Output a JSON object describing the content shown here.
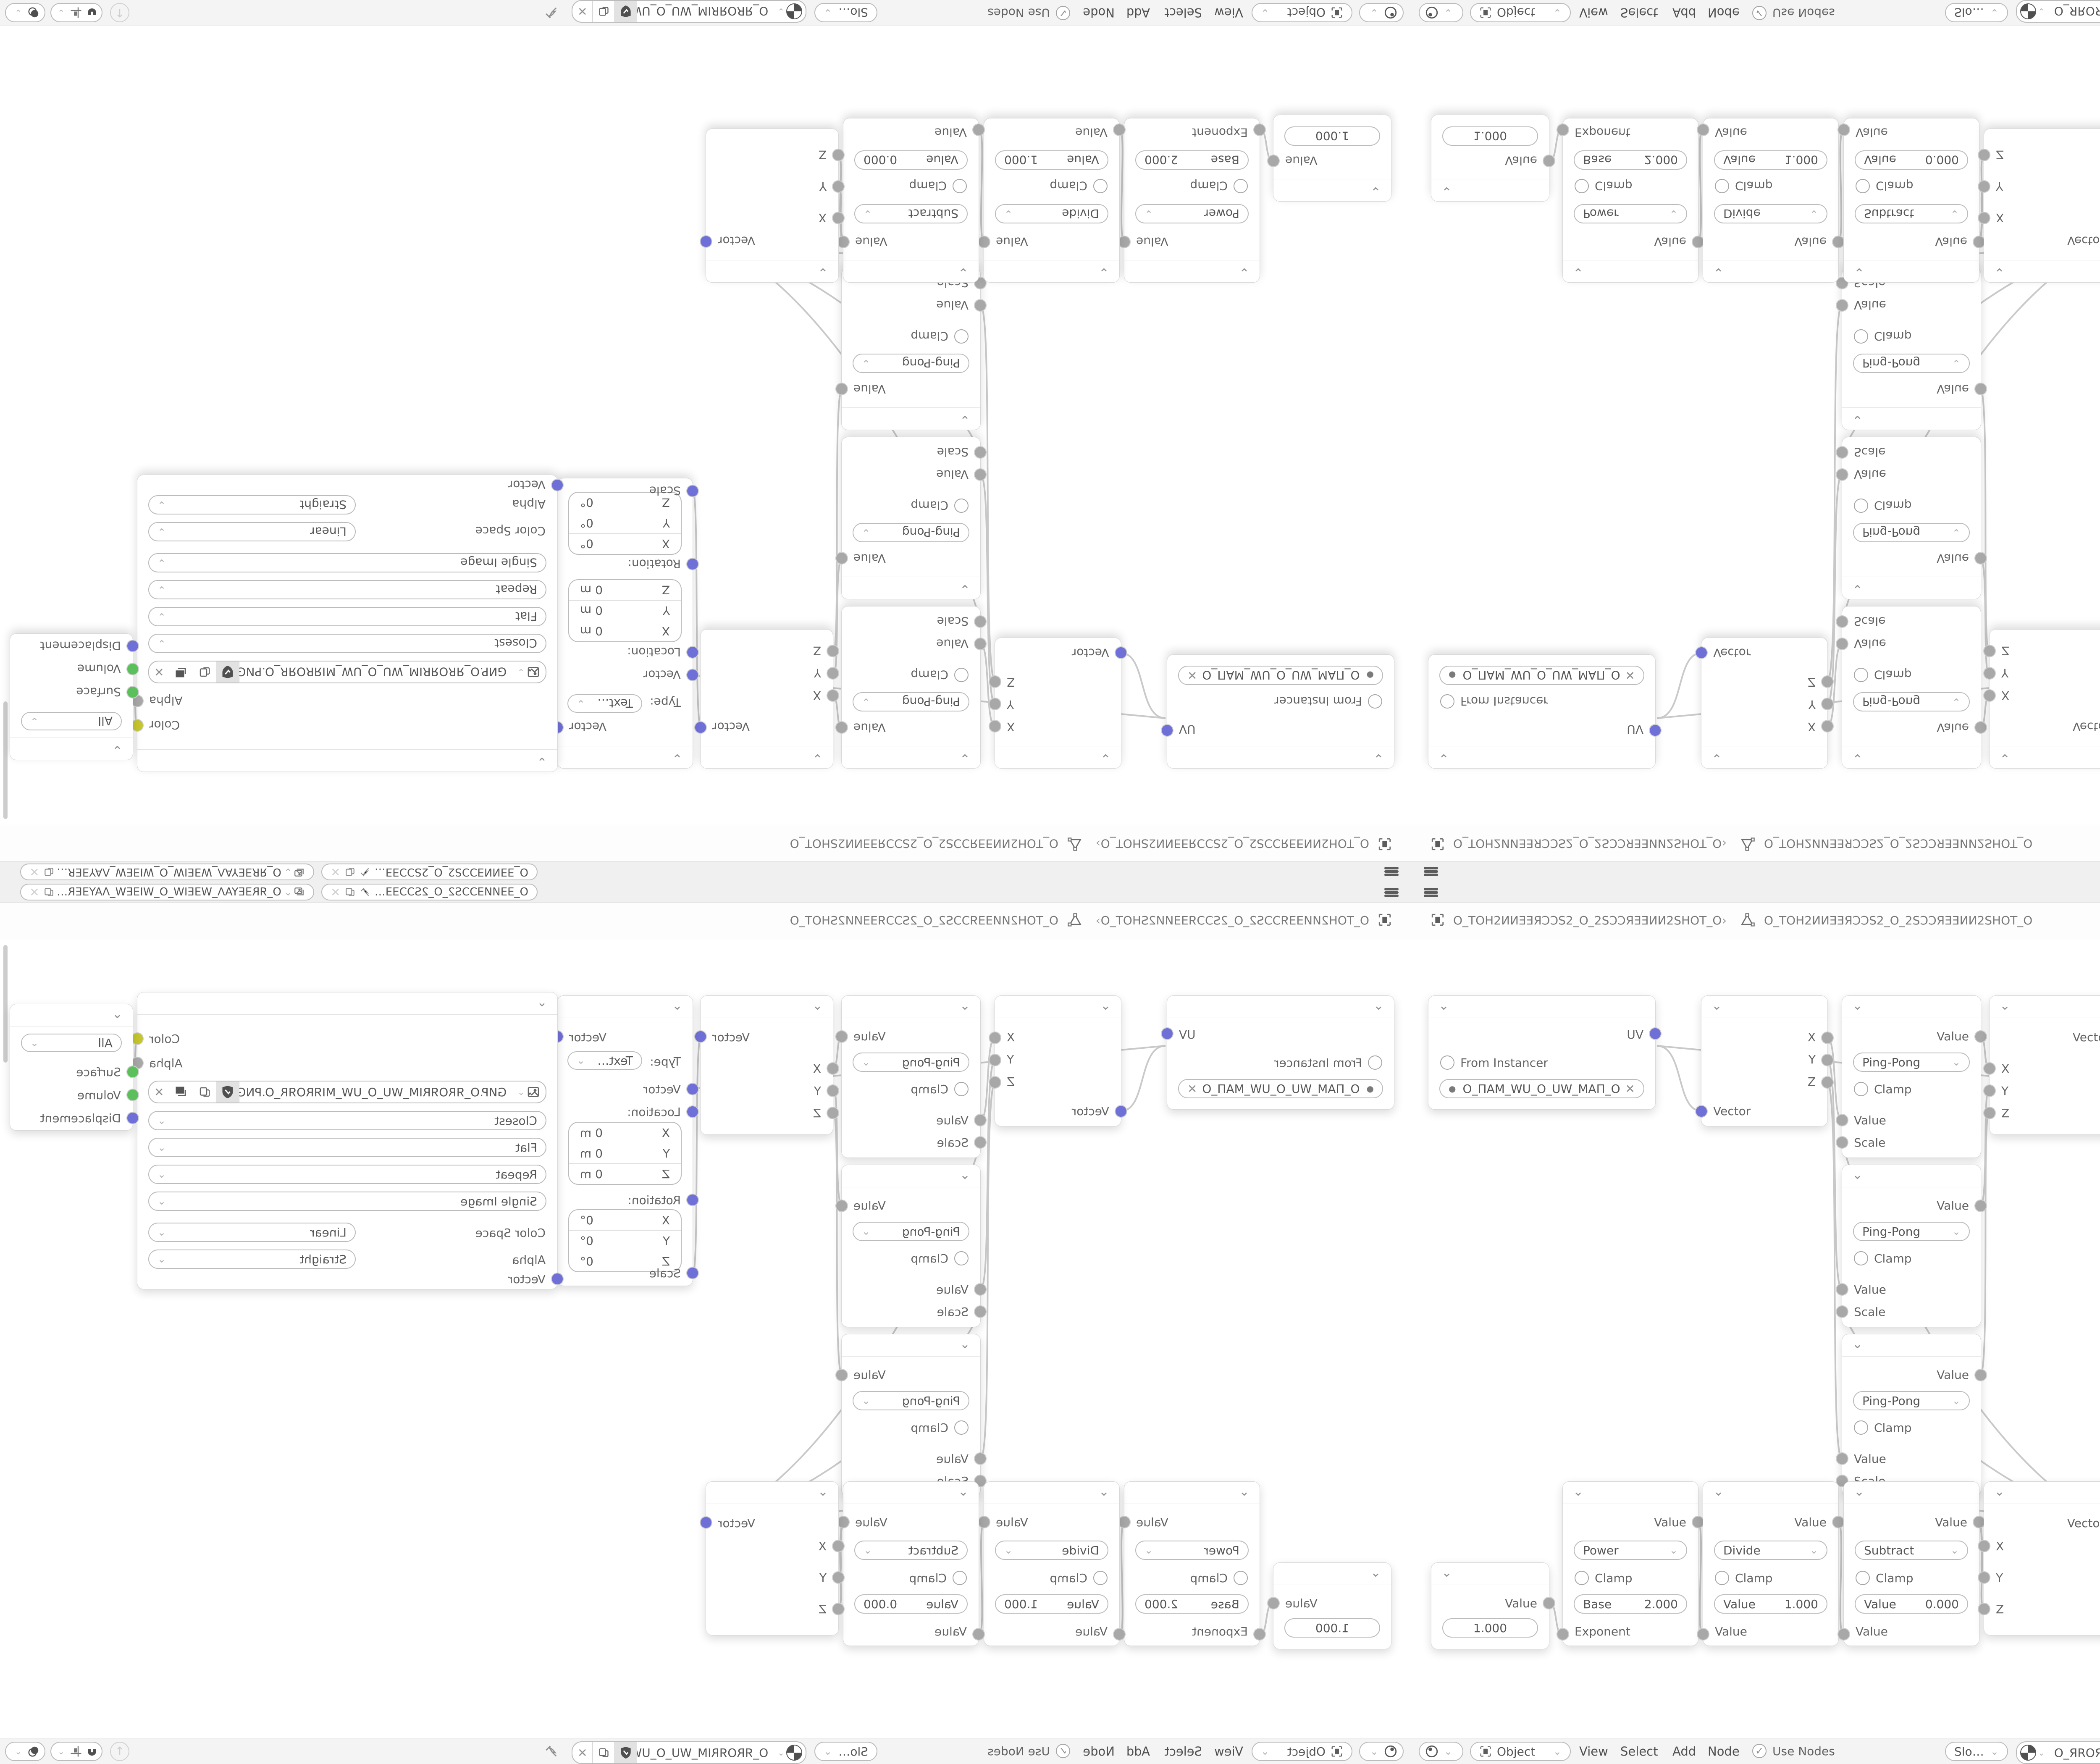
{
  "colors": {
    "vector_socket": "#6f6fd8",
    "value_socket": "#a8a8a8",
    "color_socket": "#c6c62e",
    "shader_socket": "#5bbf5b",
    "wire": "#c9c9c9",
    "bar_bg": "#f2f2f2",
    "node_bg": "#ffffff",
    "accent_text": "#555555"
  },
  "topbar": {
    "scene_field": "O_ƎƎИИƎƆƆS2_O_2SƆƆƎƎИ...",
    "viewlayer_field": "O_ЯRƎEYAΛ_WƎEIW_O_WIƎEW_ΛAYƎERЯ_O"
  },
  "breadcrumb": {
    "object": "O_TOH2ИИƎƎЯƆƆS2_O_2SƆƆЯƎƎИИ2SHOT_O",
    "separator": "›",
    "mesh": "O_TOH2ИИƎƎЯƆƆS2_O_2SƆƆЯƎƎИИ2SHOT_O"
  },
  "nodes": {
    "uv": {
      "out": "UV",
      "instancer": "From Instancer",
      "map_name": "O_ПAM_WU_O_UW_MAП_O"
    },
    "sep": {
      "outs": [
        "X",
        "Y",
        "Z"
      ],
      "in": "Vector"
    },
    "pp": {
      "out": "Value",
      "op": "Ping-Pong",
      "clamp": "Clamp",
      "in1": "Value",
      "in2": "Scale"
    },
    "comb": {
      "out": "Vector",
      "ins": [
        "X",
        "Y",
        "Z"
      ]
    },
    "map": {
      "out": "Vector",
      "type_label": "Type:",
      "type": "Texture",
      "in": "Vector",
      "loc_label": "Location:",
      "rot_label": "Rotation:",
      "scale_label": "Scale",
      "ax": "X",
      "ay": "Y",
      "az": "Z",
      "loc_v": "0 m",
      "rot_v": "0°"
    },
    "tex": {
      "out1": "Color",
      "out2": "Alpha",
      "file": "GИP.O_ЯROЯRIM_WU_O_UW_MIЯROЯR_O.PNG",
      "interp": "Closest",
      "proj": "Flat",
      "ext": "Repeat",
      "src": "Single Image",
      "cs_label": "Color Space",
      "cs": "Linear",
      "alpha_label": "Alpha",
      "alpha": "Straight",
      "in": "Vector"
    },
    "out": {
      "target": "All",
      "ins": [
        "Surface",
        "Volume",
        "Displacement"
      ]
    },
    "val": {
      "out": "Value",
      "v": "1.000"
    },
    "pow": {
      "out": "Value",
      "op": "Power",
      "clamp": "Clamp",
      "f_label": "Base",
      "f": "2.000",
      "in": "Exponent"
    },
    "div": {
      "out": "Value",
      "op": "Divide",
      "clamp": "Clamp",
      "f_label": "Value",
      "f": "1.000",
      "in": "Value"
    },
    "sub": {
      "out": "Value",
      "op": "Subtract",
      "clamp": "Clamp",
      "f_label": "Value",
      "f": "0.000",
      "in": "Value"
    }
  },
  "header": {
    "mode": "Object",
    "menus": [
      "View",
      "Select",
      "Add",
      "Node"
    ],
    "use_nodes": "Use Nodes",
    "slot": "Slot 1",
    "material": "O_ЯROЯRIM_WU_O_UW_MIЯROЯR_O"
  }
}
